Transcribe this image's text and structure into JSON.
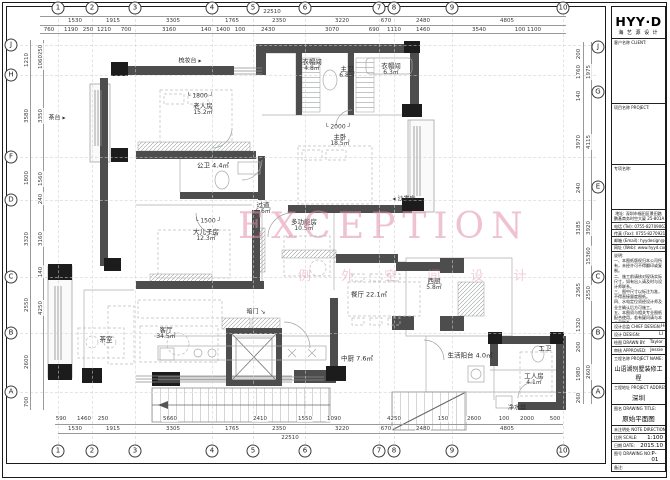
{
  "watermark": {
    "line1": "EXCEPTION",
    "line2": "例 外 空 间 设 计"
  },
  "grid": {
    "cols": [
      {
        "n": "1",
        "x": 58
      },
      {
        "n": "2",
        "x": 92
      },
      {
        "n": "3",
        "x": 135
      },
      {
        "n": "4",
        "x": 212
      },
      {
        "n": "5",
        "x": 253
      },
      {
        "n": "6",
        "x": 305
      },
      {
        "n": "7",
        "x": 379
      },
      {
        "n": "8",
        "x": 394
      },
      {
        "n": "9",
        "x": 452
      },
      {
        "n": "10",
        "x": 563
      }
    ],
    "rows_left": [
      {
        "n": "J",
        "y": 45
      },
      {
        "n": "H",
        "y": 75
      },
      {
        "n": "F",
        "y": 157
      },
      {
        "n": "D",
        "y": 200
      },
      {
        "n": "C",
        "y": 277
      },
      {
        "n": "B",
        "y": 333
      },
      {
        "n": "A",
        "y": 392
      }
    ],
    "rows_right": [
      {
        "n": "J",
        "y": 47
      },
      {
        "n": "G",
        "y": 92
      },
      {
        "n": "E",
        "y": 187
      },
      {
        "n": "C",
        "y": 277
      },
      {
        "n": "B",
        "y": 333
      },
      {
        "n": "A",
        "y": 392
      }
    ]
  },
  "dims": {
    "top_total": {
      "v": "22510",
      "x": 272,
      "y": 12
    },
    "top_row1": [
      {
        "v": "1530",
        "x": 75
      },
      {
        "v": "1915",
        "x": 113
      },
      {
        "v": "3305",
        "x": 173
      },
      {
        "v": "1765",
        "x": 232
      },
      {
        "v": "2350",
        "x": 279
      },
      {
        "v": "3220",
        "x": 342
      },
      {
        "v": "670",
        "x": 386
      },
      {
        "v": "2480",
        "x": 423
      },
      {
        "v": "4805",
        "x": 507
      }
    ],
    "top_row2": [
      {
        "v": "760",
        "x": 49
      },
      {
        "v": "1190",
        "x": 71
      },
      {
        "v": "250",
        "x": 88
      },
      {
        "v": "1210",
        "x": 104
      },
      {
        "v": "700",
        "x": 126
      },
      {
        "v": "3160",
        "x": 169
      },
      {
        "v": "140",
        "x": 206
      },
      {
        "v": "1400",
        "x": 223
      },
      {
        "v": "100",
        "x": 240
      },
      {
        "v": "2430",
        "x": 268
      },
      {
        "v": "3070",
        "x": 332
      },
      {
        "v": "690",
        "x": 374
      },
      {
        "v": "1110",
        "x": 394
      },
      {
        "v": "1460",
        "x": 423
      },
      {
        "v": "3540",
        "x": 479
      },
      {
        "v": "100",
        "x": 520
      },
      {
        "v": "1100",
        "x": 534
      }
    ],
    "bottom_row1": [
      {
        "v": "590",
        "x": 61
      },
      {
        "v": "1460",
        "x": 84
      },
      {
        "v": "250",
        "x": 103
      },
      {
        "v": "5660",
        "x": 170
      },
      {
        "v": "2410",
        "x": 260
      },
      {
        "v": "1550",
        "x": 305
      },
      {
        "v": "1090",
        "x": 334
      },
      {
        "v": "4250",
        "x": 394
      },
      {
        "v": "150",
        "x": 443
      },
      {
        "v": "2600",
        "x": 474
      },
      {
        "v": "100",
        "x": 504
      },
      {
        "v": "2000",
        "x": 527
      },
      {
        "v": "500",
        "x": 555
      }
    ],
    "bottom_row2": [
      {
        "v": "1530",
        "x": 75
      },
      {
        "v": "1915",
        "x": 113
      },
      {
        "v": "3305",
        "x": 173
      },
      {
        "v": "1765",
        "x": 232
      },
      {
        "v": "2350",
        "x": 279
      },
      {
        "v": "3220",
        "x": 342
      },
      {
        "v": "670",
        "x": 386
      },
      {
        "v": "2480",
        "x": 423
      },
      {
        "v": "4805",
        "x": 507
      }
    ],
    "bottom_total": {
      "v": "22510",
      "x": 290,
      "y": 438
    },
    "left_outer": [
      {
        "v": "1210",
        "y": 60
      },
      {
        "v": "3580",
        "y": 116
      },
      {
        "v": "1800",
        "y": 178
      },
      {
        "v": "3320",
        "y": 239
      },
      {
        "v": "2550",
        "y": 305
      },
      {
        "v": "2600",
        "y": 362
      },
      {
        "v": "700",
        "y": 402
      }
    ],
    "left_inner": [
      {
        "v": "250",
        "y": 50
      },
      {
        "v": "1060",
        "y": 62
      },
      {
        "v": "3350",
        "y": 116
      },
      {
        "v": "1560",
        "y": 179
      },
      {
        "v": "240",
        "y": 199
      },
      {
        "v": "3160",
        "y": 239
      },
      {
        "v": "140",
        "y": 272
      },
      {
        "v": "4250",
        "y": 308
      }
    ],
    "right_outer": [
      {
        "v": "1975",
        "y": 72
      },
      {
        "v": "4115",
        "y": 142
      },
      {
        "v": "3920",
        "y": 228
      },
      {
        "v": "15360",
        "y": 256
      },
      {
        "v": "2550",
        "y": 293
      },
      {
        "v": "2600",
        "y": 372
      }
    ],
    "right_inner": [
      {
        "v": "200",
        "y": 54
      },
      {
        "v": "1760",
        "y": 72
      },
      {
        "v": "140",
        "y": 96
      },
      {
        "v": "3970",
        "y": 142
      },
      {
        "v": "240",
        "y": 188
      },
      {
        "v": "3185",
        "y": 228
      },
      {
        "v": "2365",
        "y": 290
      },
      {
        "v": "1320",
        "y": 325
      },
      {
        "v": "200",
        "y": 347
      },
      {
        "v": "1980",
        "y": 374
      },
      {
        "v": "260",
        "y": 398
      }
    ]
  },
  "plan_dims": [
    {
      "v": "1800",
      "x": 200,
      "y": 96
    },
    {
      "v": "2000",
      "x": 338,
      "y": 127
    },
    {
      "v": "1500",
      "x": 208,
      "y": 221
    }
  ],
  "rooms": [
    {
      "name": "老人房",
      "area": "15.2㎡",
      "x": 203,
      "y": 110
    },
    {
      "name": "衣帽间",
      "area": "4.8㎡",
      "x": 312,
      "y": 66
    },
    {
      "name": "衣帽间",
      "area": "6.3㎡",
      "x": 391,
      "y": 70
    },
    {
      "name": "主卫",
      "area": "6.8㎡",
      "x": 347,
      "y": 73
    },
    {
      "name": "主卧",
      "area": "18.5㎡",
      "x": 340,
      "y": 141
    },
    {
      "name": "公卫 4.4㎡",
      "x": 213,
      "y": 166
    },
    {
      "name": "过道",
      "area": "6.6㎡",
      "x": 263,
      "y": 209
    },
    {
      "name": "大儿子房",
      "area": "12.3㎡",
      "x": 206,
      "y": 236
    },
    {
      "name": "多功能房",
      "area": "10.5㎡",
      "x": 304,
      "y": 226
    },
    {
      "name": "餐厅 22.1㎡",
      "x": 369,
      "y": 295
    },
    {
      "name": "西厨",
      "area": "5.8㎡",
      "x": 434,
      "y": 285
    },
    {
      "name": "客厅",
      "area": "34.5㎡",
      "x": 166,
      "y": 334
    },
    {
      "name": "茶室",
      "x": 106,
      "y": 340
    },
    {
      "name": "中厨 7.6㎡",
      "x": 357,
      "y": 359
    },
    {
      "name": "生活阳台 4.0㎡",
      "x": 470,
      "y": 356
    },
    {
      "name": "工卫",
      "x": 545,
      "y": 349
    },
    {
      "name": "工人房",
      "area": "4.1㎡",
      "x": 534,
      "y": 380
    }
  ],
  "annotations": [
    {
      "t": "梳妆台",
      "x": 190,
      "y": 60,
      "arrow": "r"
    },
    {
      "t": "茶台",
      "x": 57,
      "y": 117,
      "arrow": "r"
    },
    {
      "t": "沙发床",
      "x": 404,
      "y": 198,
      "arrow": "l"
    },
    {
      "t": "暗门",
      "x": 256,
      "y": 311,
      "arrow": "d"
    },
    {
      "t": "净水器",
      "x": 517,
      "y": 407,
      "arrow": ""
    }
  ],
  "title_block": {
    "logo": "HYY·D",
    "logo_sub": "海 艺 源 设 计",
    "section1_label": "客户名称 CLIENT:",
    "section2_label": "项目名称 PROJECT:",
    "section3_label": "专项名称:",
    "address_lines": [
      "地址: 深圳市福田区景田路",
      "鹏基商务时空大厦 25-801A"
    ],
    "contact_rows": [
      "电话 (Tel): 0755-82709063",
      "传真 (Fax): 0755-82709213",
      "邮箱 (Email): hyydesign@126.com",
      "网址 (Web): www.hyyd.com"
    ],
    "notes_title": "说明:",
    "notes": [
      "一、本图纸版权归本公司所有，未经许可不得翻印或复制。",
      "二、施工前请核对现场实际尺寸，如有出入请及时与设计师联系。",
      "三、图中尺寸以标注为准，不得直接量度图纸。",
      "四、水电定位须经设计师及业主确认后方可施工。",
      "五、本图须与相关专业图纸配合使用，若有疑问请与本公司联系。"
    ],
    "credits": [
      {
        "label": "设计总监 CHIEF DESIGN:",
        "value": "Henry"
      },
      {
        "label": "设计 DESIGN:",
        "value": "LI"
      },
      {
        "label": "绘图 DRAWN BY:",
        "value": "Taylor"
      },
      {
        "label": "审核 APPROVED:",
        "value": "Jessie"
      }
    ],
    "project_name_label": "工程名称 PROJECT NAME:",
    "project_name": "山语湖别墅装修工程",
    "project_addr_label": "工程地址 PROJECT ADDRESS:",
    "project_addr": "深圳",
    "drawing_title_label": "图名 DRAWING TITLE:",
    "drawing_title": "原始平面图",
    "note_dir_label": "未注明处 NOTE DIRECTION:",
    "scale_label": "比例 SCALE:",
    "scale": "1:100",
    "date_label": "日期 DATE:",
    "date": "2015.10",
    "no_label": "图号 DRAWING NO:",
    "no": "P-01",
    "remark_label": "备注:"
  }
}
